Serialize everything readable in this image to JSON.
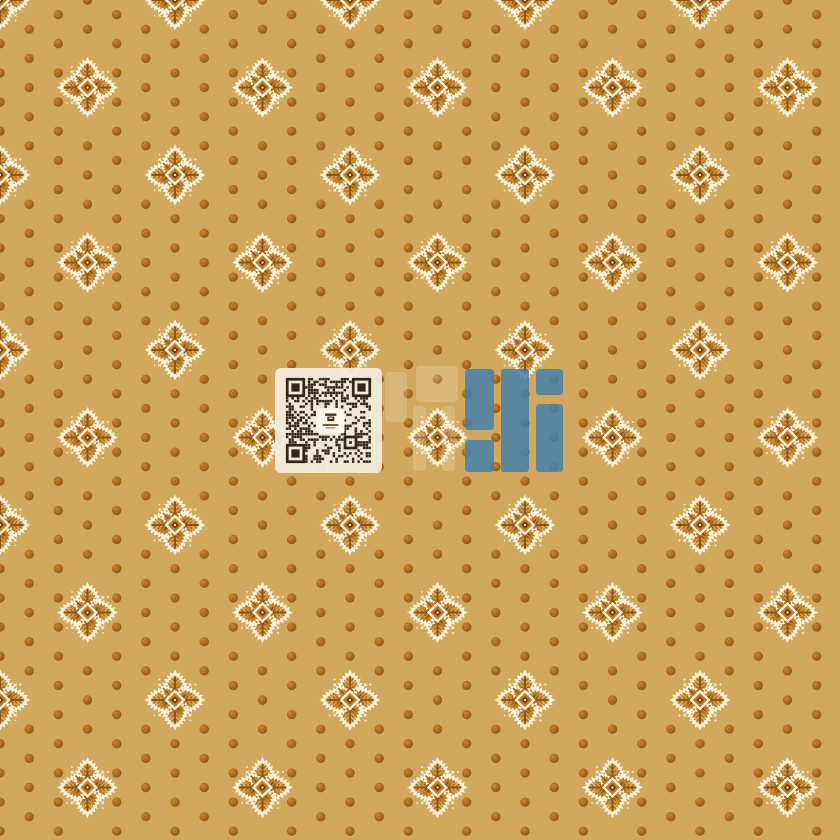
{
  "meta": {
    "description": "Seamless tan damask wallpaper swatch: cream ornamental cross motifs and brown polka dots on a golden-tan ground, with a centered QR-code watermark and translucent blue brand logo",
    "canvas": {
      "width": 840,
      "height": 840
    }
  },
  "palette": {
    "background": "#D2A85E",
    "dot": "#A8691E",
    "dot_highlight": "#C28732",
    "dot_shadow": "#8A5312",
    "motif_cream": "#F8F1DC",
    "motif_orange": "#BE7E27",
    "motif_orange_light": "#D9A95C",
    "motif_brown": "#8F5314",
    "motif_deep_brown": "#703D0A",
    "qr_panel": "#F2ECDE",
    "qr_module": "#31261A",
    "qr_emblem_brown": "#4A3322",
    "qr_emblem_text": "#6B4A2E",
    "logo_blue": "#447FAB",
    "ghost_white": "#FFFFFF"
  },
  "pattern": {
    "motif_spacing": 87.5,
    "motif_grid_count": 10,
    "motif_half_size": 30.5,
    "dot_step_x": 29.1667,
    "dot_step_y": 14.5833,
    "dot_radius": 4.7,
    "dot_cols": 29,
    "dot_rows": 58
  },
  "watermark": {
    "qr": {
      "x": 275,
      "y": 368,
      "width": 107,
      "height": 105,
      "corner_radius": 6,
      "modules": 31,
      "module_size": 2.75,
      "finder_modules": 7,
      "panel_opacity": 0.94,
      "emblem": {
        "x": 316.5,
        "y": 408.5,
        "width": 28,
        "height": 25
      }
    },
    "ghost_bars": [
      {
        "x": 385,
        "y": 372,
        "w": 22,
        "h": 50
      },
      {
        "x": 416,
        "y": 366,
        "w": 42,
        "h": 36
      },
      {
        "x": 413,
        "y": 406,
        "w": 13,
        "h": 65
      },
      {
        "x": 442,
        "y": 406,
        "w": 13,
        "h": 65
      }
    ],
    "ghost_opacity": 0.18,
    "logo_bars": [
      {
        "x": 465,
        "y": 369,
        "w": 29,
        "h": 61
      },
      {
        "x": 465,
        "y": 440,
        "w": 29,
        "h": 32
      },
      {
        "x": 501,
        "y": 369,
        "w": 28,
        "h": 103
      },
      {
        "x": 536,
        "y": 369,
        "w": 27,
        "h": 26
      },
      {
        "x": 536,
        "y": 404,
        "w": 27,
        "h": 68
      }
    ],
    "logo_opacity": 0.84
  }
}
